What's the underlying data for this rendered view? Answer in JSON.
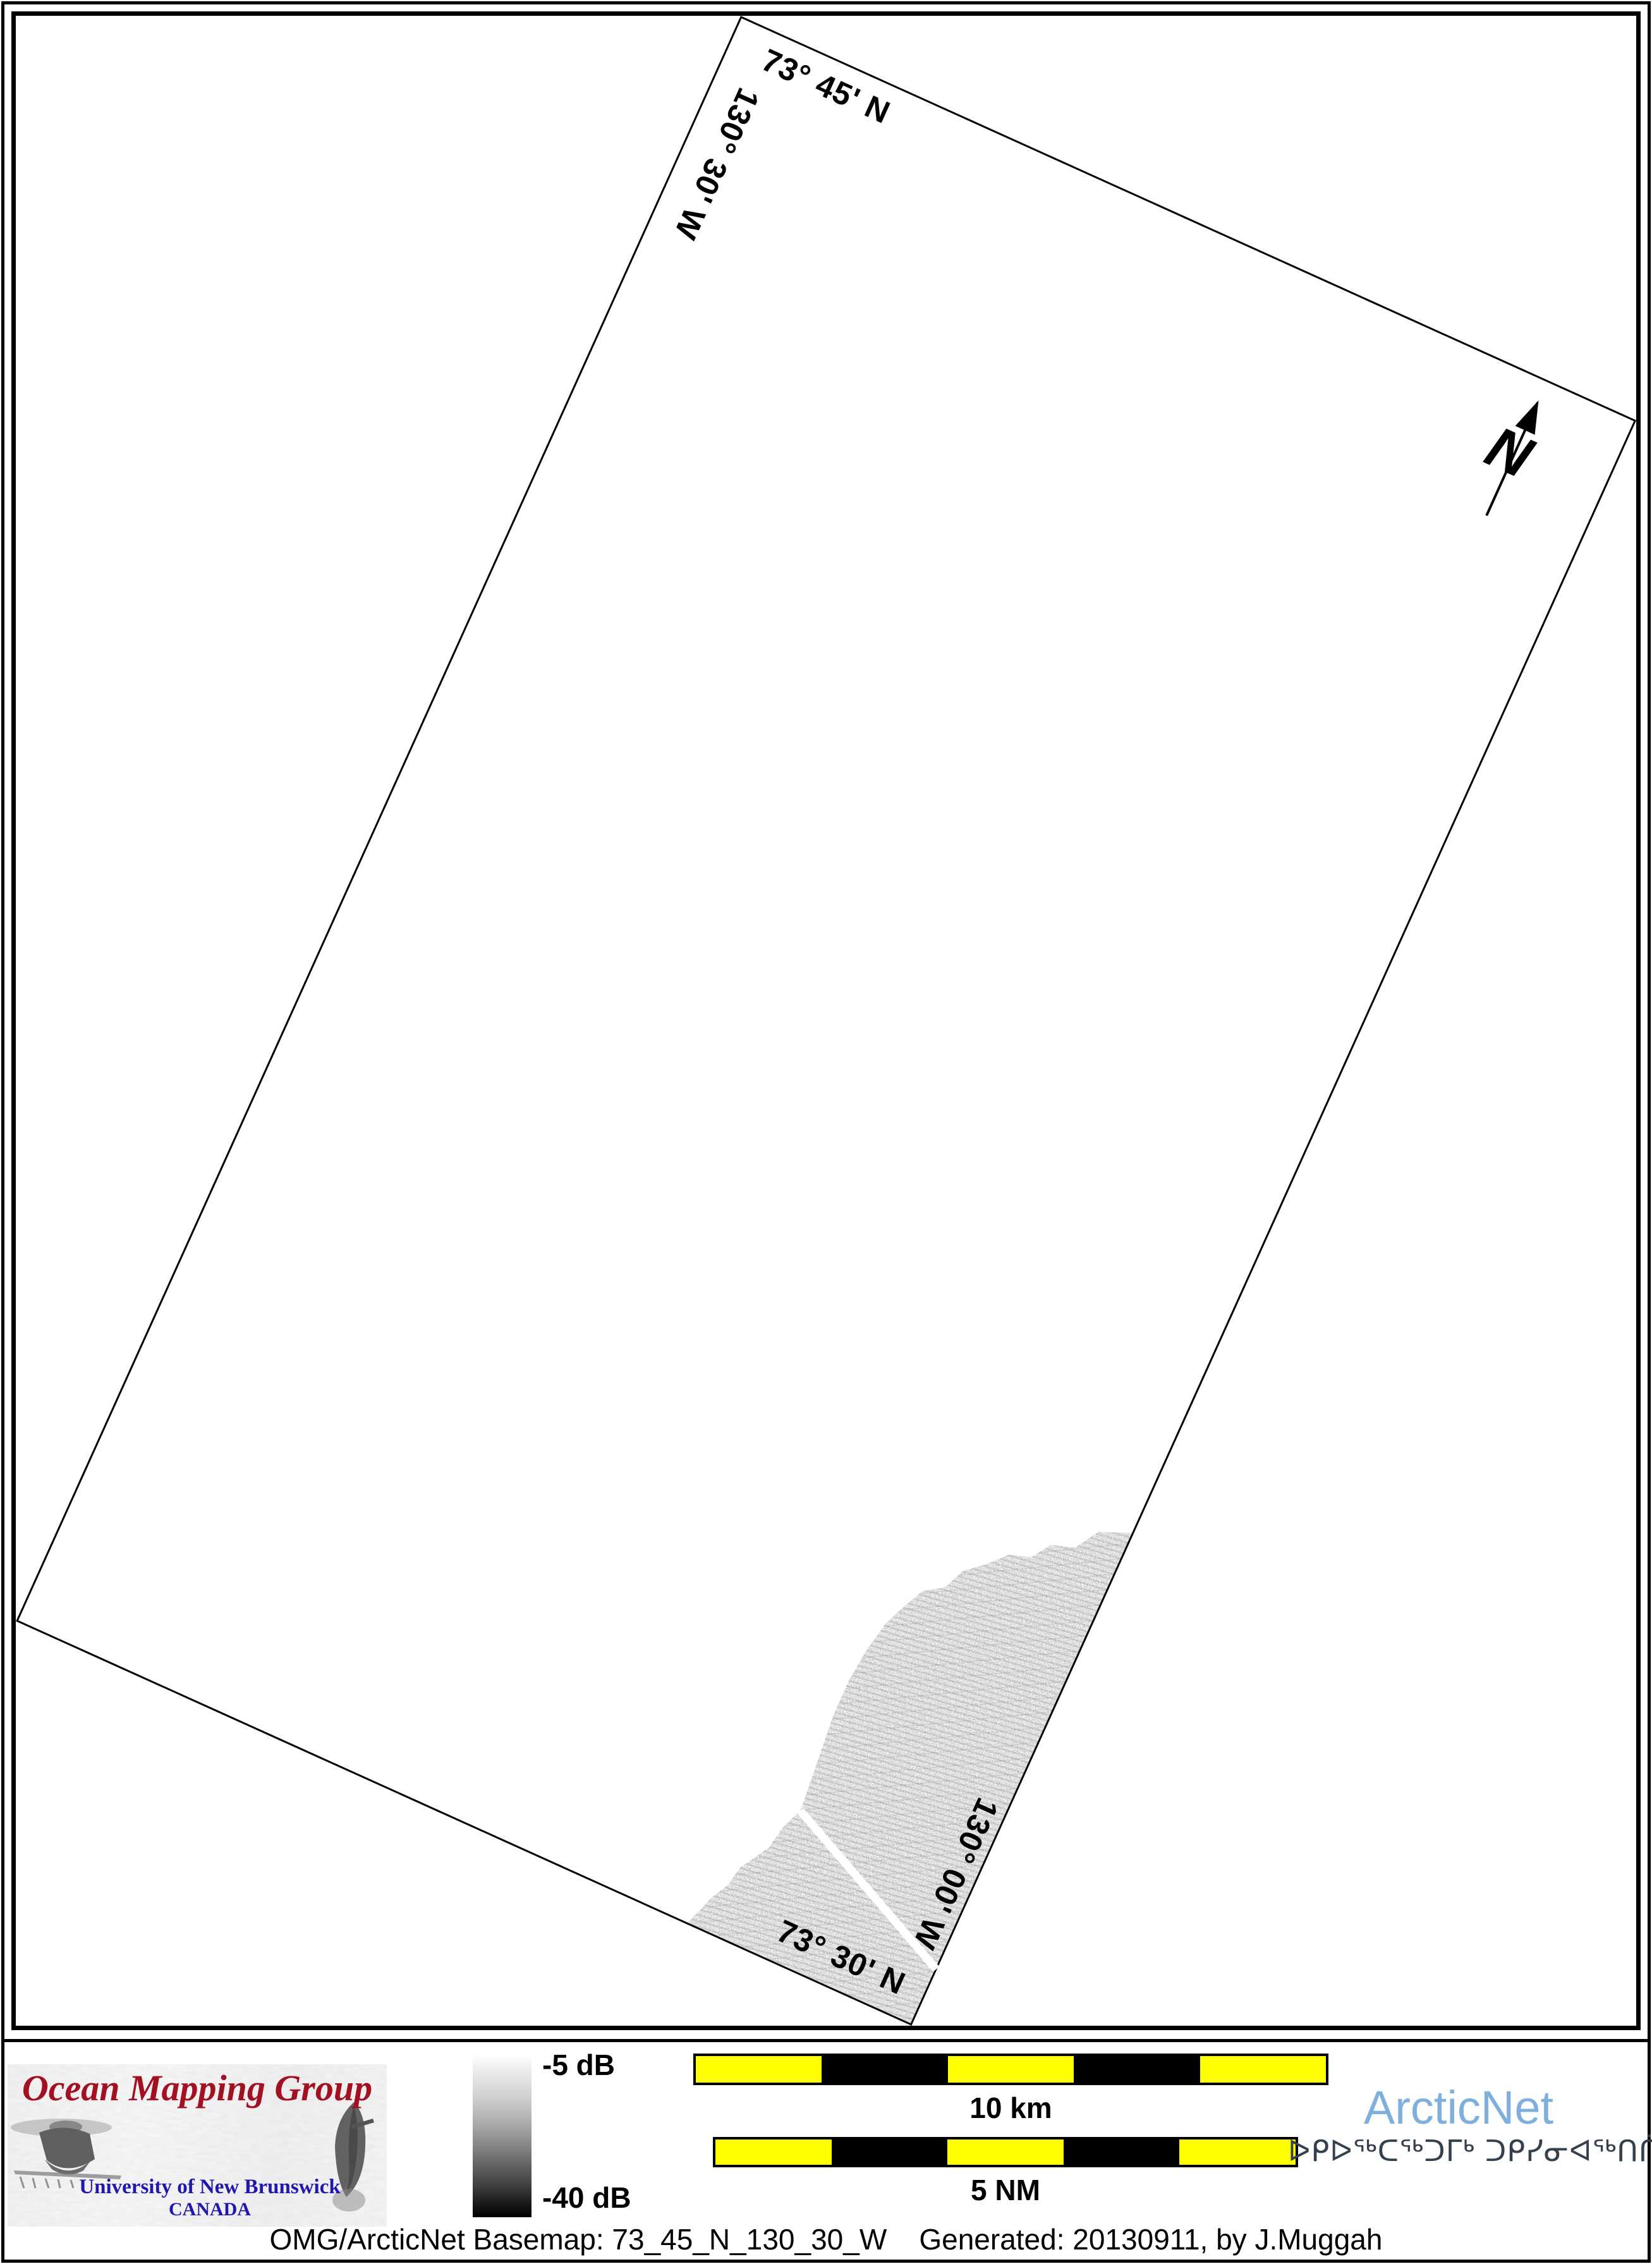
{
  "map": {
    "corner_labels": {
      "top_lat": "73° 45' N",
      "left_lon": "130° 30' W",
      "bottom_lat": "73° 30' N",
      "right_lon": "130° 00' W"
    },
    "north_label": "N",
    "rotation_deg": 24.3
  },
  "legend": {
    "colorbar_top": "-5 dB",
    "colorbar_bottom": "-40 dB"
  },
  "scalebars": {
    "km": {
      "label": "10 km",
      "segments": [
        "yellow",
        "black",
        "yellow",
        "black",
        "yellow"
      ]
    },
    "nm": {
      "label": "5 NM",
      "segments": [
        "yellow",
        "black",
        "yellow",
        "black",
        "yellow"
      ]
    }
  },
  "logos": {
    "omg": {
      "title": "Ocean Mapping Group",
      "subtitle": "University of New Brunswick",
      "country": "CANADA"
    },
    "arcticnet": {
      "name": "ArcticNet",
      "inuktitut": "ᐅᑭᐅᖅᑕᖅᑐᒥᒃ ᑐᑭᓯᓂᐊᖅᑎᑏᑦ"
    }
  },
  "caption": "OMG/ArcticNet Basemap: 73_45_N_130_30_W    Generated: 20130911, by J.Muggah",
  "colors": {
    "scalebar_yellow": "#ffff00",
    "scalebar_black": "#000000",
    "arcticnet_blue": "#7fb0dd",
    "syllabics_navy": "#35404f",
    "omg_red": "#a31022",
    "omg_blue": "#2017b0"
  }
}
